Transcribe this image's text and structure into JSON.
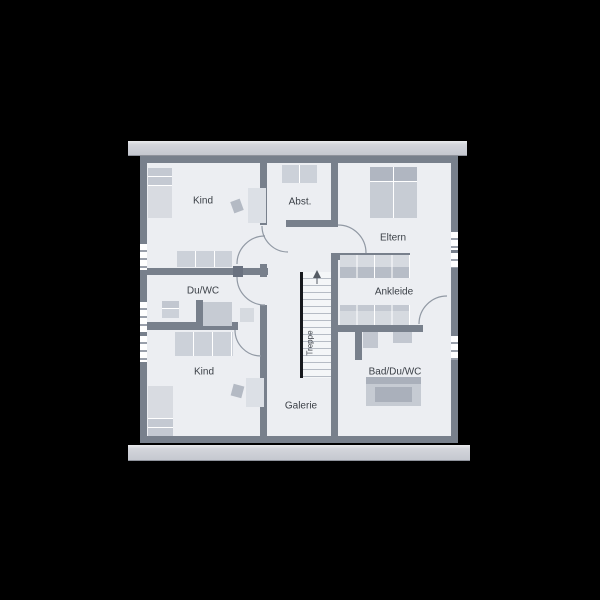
{
  "background_color": "#000000",
  "floorplan": {
    "type": "attic-floor-plan",
    "labels": {
      "kind_top": "Kind",
      "abst": "Abst.",
      "eltern": "Eltern",
      "du_wc": "Du/WC",
      "ankleide": "Ankleide",
      "treppe": "Treppe",
      "bad_du_wc": "Bad/Du/WC",
      "galerie": "Galerie",
      "kind_bottom": "Kind"
    },
    "stairs": {
      "label": "Treppe",
      "step_count": 16,
      "direction_arrow": "up"
    },
    "window_count": 6,
    "colors": {
      "wall": "#78808c",
      "floor": "#eceef2",
      "roof_bar": "#ced1d7",
      "furniture": "#d2d6dd",
      "furniture_dark": "#b0b6c1",
      "stair_rail": "#17191d",
      "label_text": "#3a3f46"
    }
  }
}
